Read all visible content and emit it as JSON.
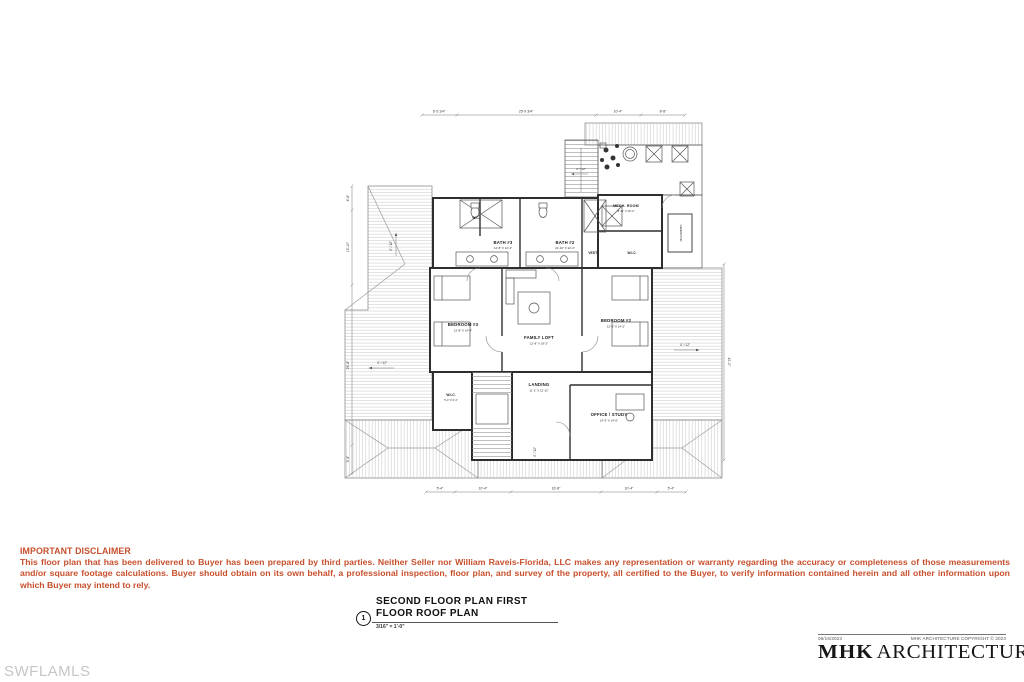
{
  "watermark": {
    "text": "SWFLAMLS",
    "color": "#c6c6c6"
  },
  "disclaimer": {
    "heading": "IMPORTANT DISCLAIMER",
    "body": "This floor plan that has been delivered to Buyer has been prepared by third parties. Neither Seller nor William Raveis-Florida, LLC makes any representation or warranty regarding the accuracy or completeness of those measurements and/or square footage calculations. Buyer should obtain on its own behalf, a professional inspection, floor plan, and survey of the property, all certified to the Buyer, to verify information contained herein and all other information upon which Buyer may intend to rely.",
    "color": "#c74f2c"
  },
  "title_block": {
    "number": "1",
    "line1": "SECOND FLOOR PLAN FIRST",
    "line2": "FLOOR ROOF PLAN",
    "scale": "3/16\" = 1'-0\""
  },
  "architect": {
    "date": "06/16/2023",
    "copyright": "MHK ARCHITECTURE COPYRIGHT © 2023",
    "logo_mhk": "MHK",
    "logo_rest": "ARCHITECTURE"
  },
  "plan": {
    "rooms": {
      "wc": {
        "name": "W.C."
      },
      "bath3": {
        "name": "BATH #3",
        "dims": "12'-8\" X 12'-4\""
      },
      "bath2": {
        "name": "BATH #2",
        "dims": "12'-10\" X 12'-4\""
      },
      "vest": {
        "name": "VEST."
      },
      "wic_upper": {
        "name": "W.I.C."
      },
      "mech": {
        "name": "MECH. ROOM",
        "dims": "8'-11\" X 10'-4\""
      },
      "generator": {
        "name": "GENERATOR"
      },
      "bedroom3": {
        "name": "BEDROOM #3",
        "dims": "12'-8\" X 14'-4\""
      },
      "family_loft": {
        "name": "FAMILY LOFT",
        "dims": "12'-8\" X 19'-2\""
      },
      "bedroom2": {
        "name": "BEDROOM #2",
        "dims": "12'-8\" X 14'-2\""
      },
      "wic_lower": {
        "name": "W.I.C.",
        "dims": "5'-4\" X 6'-4\""
      },
      "landing": {
        "name": "LANDING",
        "dims": "11'-2\" X 12'-11\""
      },
      "office": {
        "name": "OFFICE / STUDY",
        "dims": "14'-3\" X 14'-6\""
      }
    },
    "dims": {
      "top": [
        "6'-5 1/4\"",
        "25'-9 3/4\"",
        "10'-4\"",
        "8'-8\""
      ],
      "left": [
        "4'-6\"",
        "13'-10\"",
        "29'-8\"",
        "5'-4\""
      ],
      "bottom": [
        "5'-4\"",
        "10'-4\"",
        "16'-8\"",
        "10'-4\"",
        "5'-4\""
      ],
      "right": [
        "41'-0\""
      ]
    },
    "slopes": {
      "main": "4\" / 12\"",
      "low": "3\" / 12\""
    }
  }
}
